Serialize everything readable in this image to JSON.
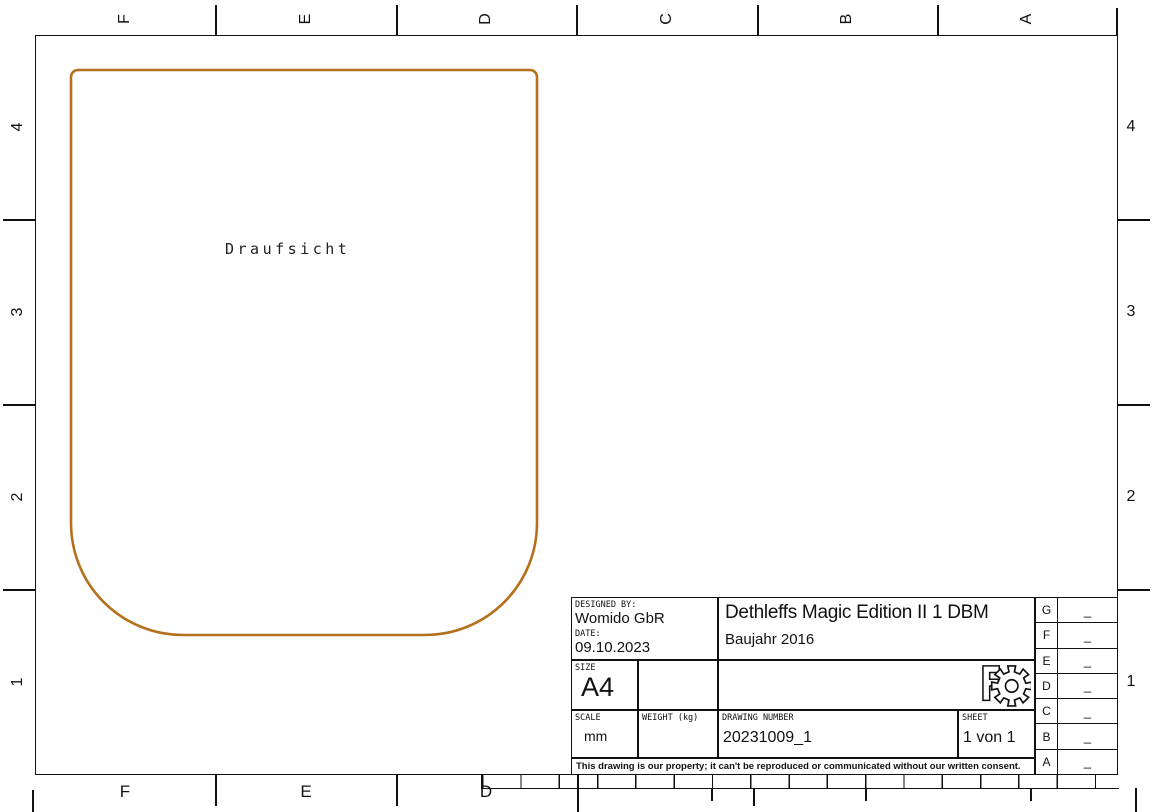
{
  "sheet": {
    "view": {
      "label": "Draufsicht",
      "outline_color": "#b4701a"
    },
    "frame": {
      "top": [
        "F",
        "E",
        "D",
        "C",
        "B",
        "A"
      ],
      "bottom": [
        "F",
        "E",
        "D"
      ],
      "left": [
        "4",
        "3",
        "2",
        "1"
      ],
      "right": [
        "4",
        "3",
        "2",
        "1"
      ]
    },
    "title_block": {
      "designed_by_label": "DESIGNED BY:",
      "designed_by": "Womido GbR",
      "date_label": "DATE:",
      "date": "09.10.2023",
      "size_label": "SIZE",
      "size": "A4",
      "title": "Dethleffs Magic Edition II 1 DBM",
      "subtitle": "Baujahr 2016",
      "scale_label": "SCALE",
      "scale": "mm",
      "weight_label": "WEIGHT (kg)",
      "weight": "",
      "drawing_number_label": "DRAWING NUMBER",
      "drawing_number": "20231009_1",
      "sheet_label": "SHEET",
      "sheet": "1 von 1",
      "disclaimer": "This drawing is our property; it can't be reproduced or communicated without our written consent.",
      "revisions": [
        {
          "zone": "G",
          "value": "_"
        },
        {
          "zone": "F",
          "value": "_"
        },
        {
          "zone": "E",
          "value": "_"
        },
        {
          "zone": "D",
          "value": "_"
        },
        {
          "zone": "C",
          "value": "_"
        },
        {
          "zone": "B",
          "value": "_"
        },
        {
          "zone": "A",
          "value": "_"
        }
      ]
    }
  }
}
